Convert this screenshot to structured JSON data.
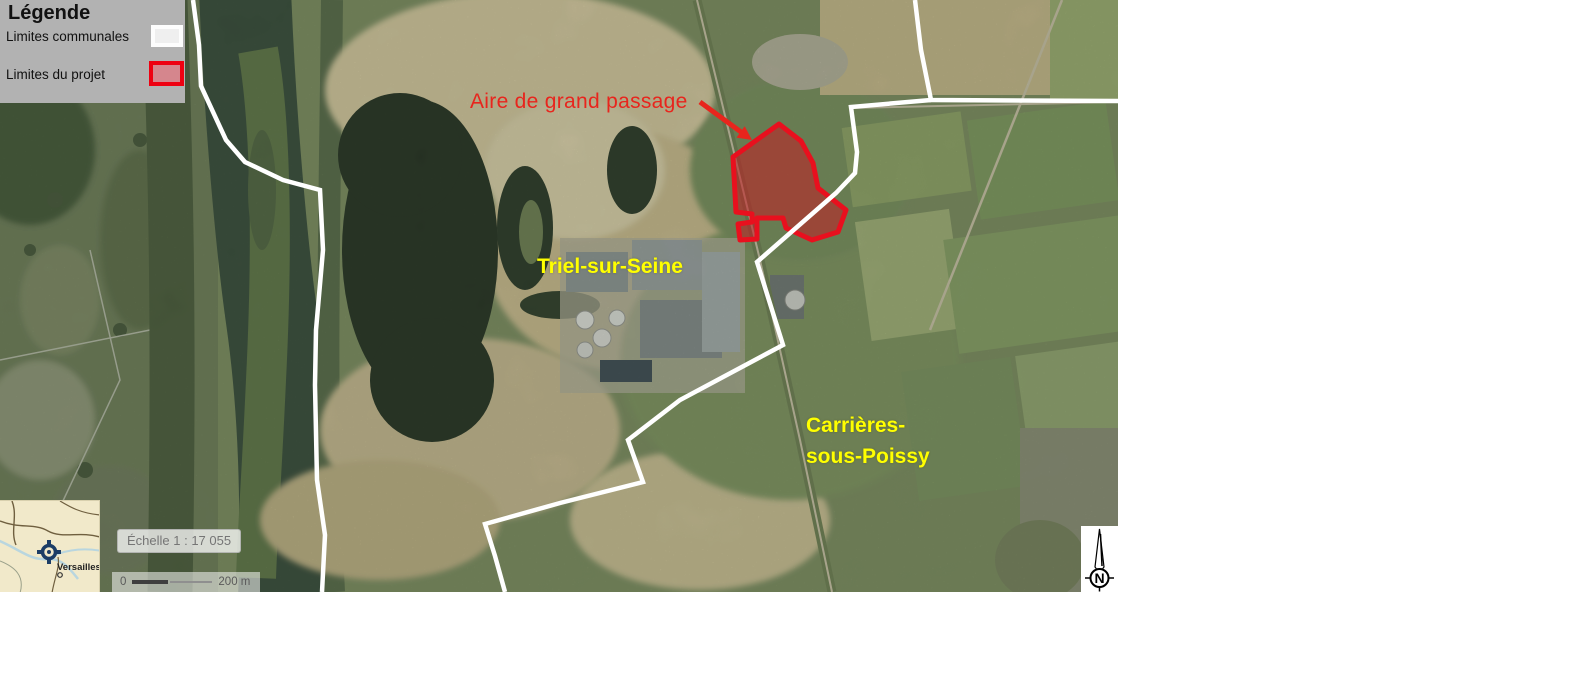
{
  "legend": {
    "title": "Légende",
    "items": [
      {
        "label": "Limites communales",
        "swatch_fill": "#efefef",
        "swatch_border": "#ffffff"
      },
      {
        "label": "Limites du projet",
        "swatch_fill": "#d5868d",
        "swatch_border": "#ee0011"
      }
    ]
  },
  "labels": {
    "project_annotation": "Aire de grand passage",
    "city_triel": "Triel-sur-Seine",
    "city_carrieres_line1": "Carrières-",
    "city_carrieres_line2": "sous-Poissy"
  },
  "scale": {
    "ratio_text": "Échelle 1 : 17 055",
    "bar_zero": "0",
    "bar_max": "200 m"
  },
  "inset": {
    "place": "Versailles"
  },
  "compass": {
    "north_letter": "N"
  },
  "colors": {
    "legend_bg": "#b2b2b2",
    "communal_boundary": "#ffffff",
    "project_boundary_stroke": "#e8101e",
    "project_boundary_fill": "rgba(195,28,35,0.55)",
    "annotation_red": "#e8251d",
    "city_label_yellow": "#ffff00"
  }
}
